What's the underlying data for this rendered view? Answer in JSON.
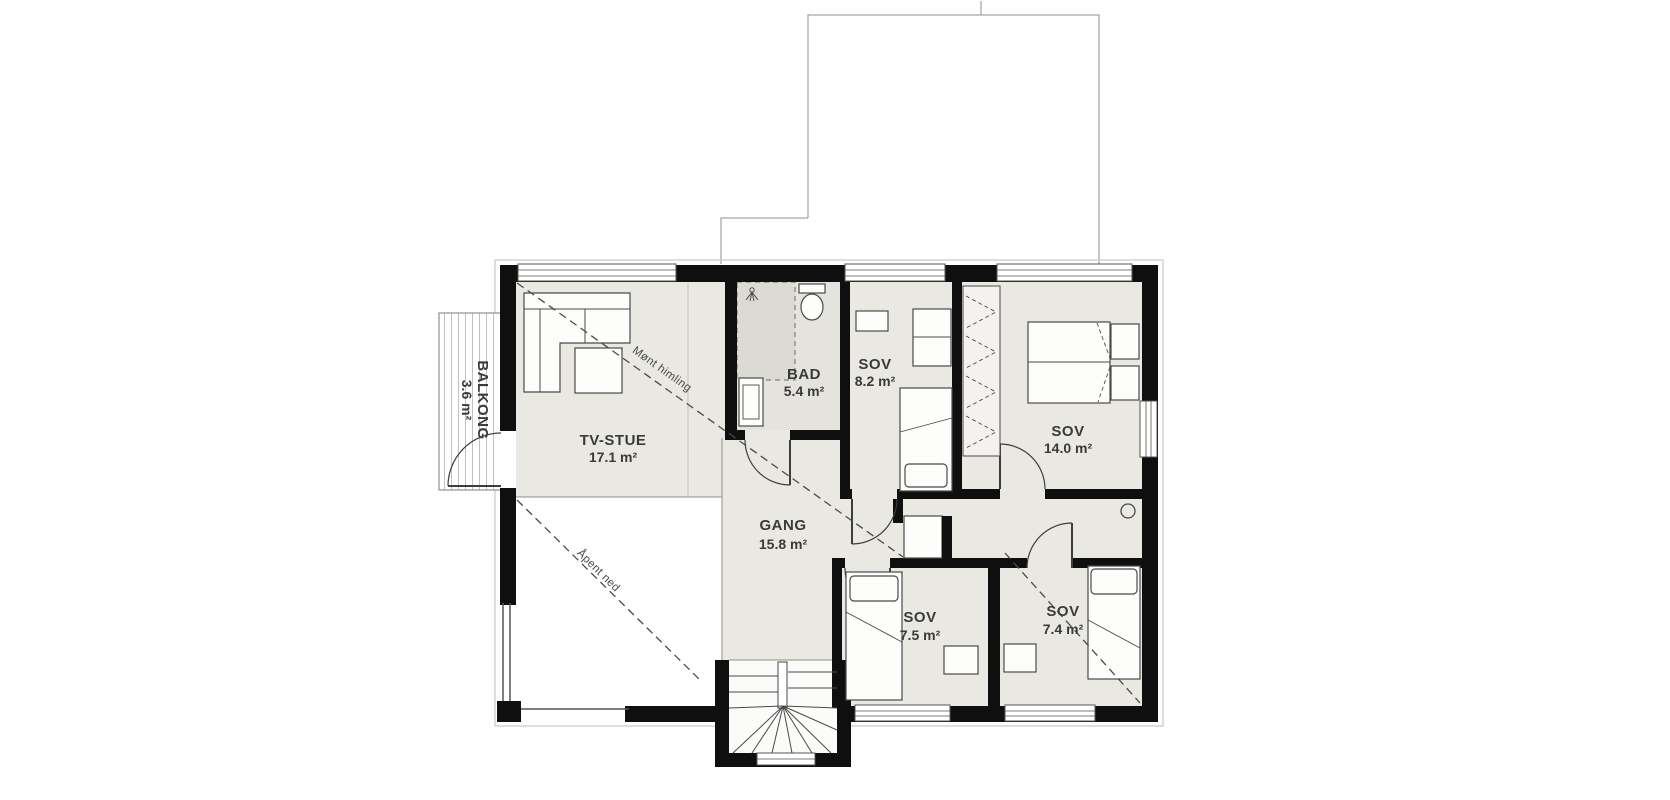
{
  "plan": {
    "rooms": [
      {
        "id": "tv-stue",
        "name": "TV-STUE",
        "area": "17.1 m²"
      },
      {
        "id": "bad",
        "name": "BAD",
        "area": "5.4 m²"
      },
      {
        "id": "sov-8-2",
        "name": "SOV",
        "area": "8.2 m²"
      },
      {
        "id": "sov-14-0",
        "name": "SOV",
        "area": "14.0 m²"
      },
      {
        "id": "gang",
        "name": "GANG",
        "area": "15.8 m²"
      },
      {
        "id": "sov-7-5",
        "name": "SOV",
        "area": "7.5 m²"
      },
      {
        "id": "sov-7-4",
        "name": "SOV",
        "area": "7.4 m²"
      },
      {
        "id": "balkong",
        "name": "BALKONG",
        "area": "3.6 m²"
      }
    ],
    "annotations": {
      "sloped_ceiling": "Mønt himling",
      "open_below": "Åpent ned"
    },
    "colors": {
      "wall": "#0f0f0f",
      "floor": "#e9e8e2",
      "bath_floor": "#e4e3dd",
      "shower_floor": "#dcdbd3",
      "annotation_line": "#4a4a4a"
    }
  }
}
